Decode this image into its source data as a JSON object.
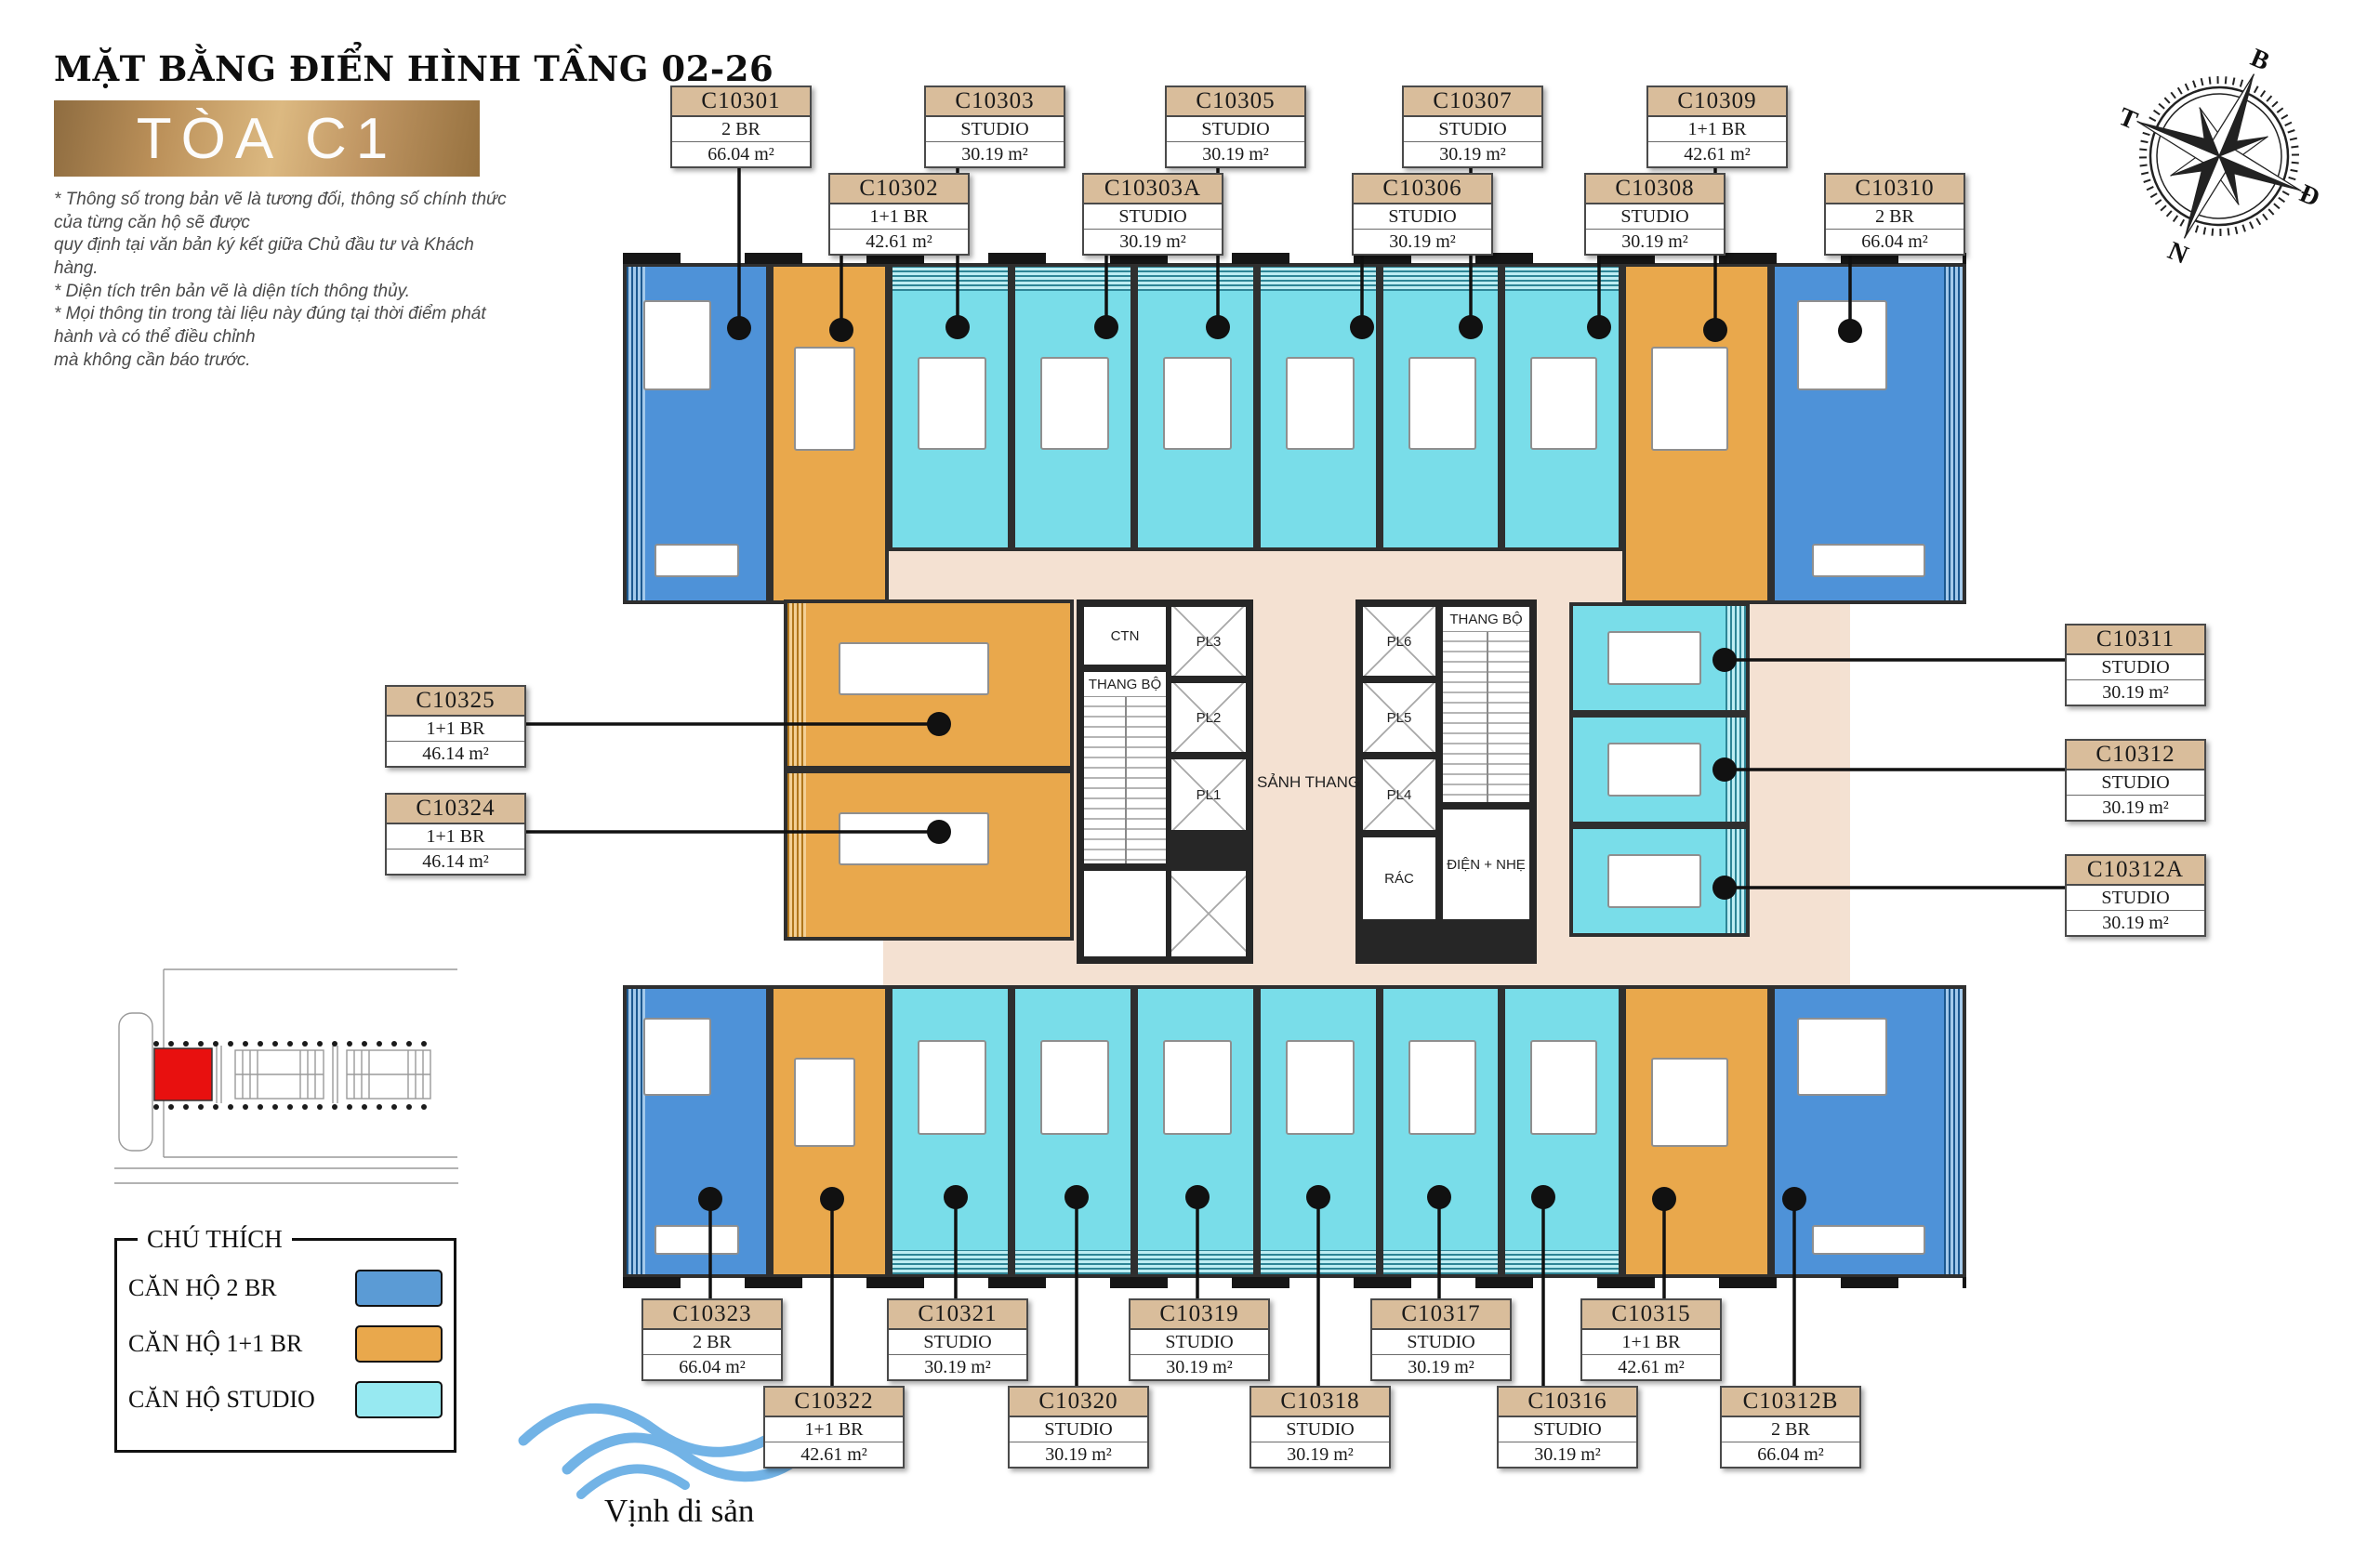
{
  "header": {
    "title": "MẶT BẰNG ĐIỂN HÌNH TẦNG 02-26",
    "building": "TÒA C1",
    "disclaimer_lines": [
      "* Thông số trong bản vẽ là tương đối, thông số chính thức của từng căn hộ sẽ được",
      "quy định tại văn bản ký kết giữa Chủ đầu tư và Khách hàng.",
      "* Diện tích trên bản vẽ là diện tích thông thủy.",
      "* Mọi thông tin trong tài liệu này đúng tại thời điểm phát hành và có thể điều chỉnh",
      "mà không cần báo trước."
    ]
  },
  "compass": {
    "north": "B",
    "east": "Đ",
    "south": "N",
    "west": "T"
  },
  "legend": {
    "title": "CHÚ THÍCH",
    "items": [
      {
        "label": "CĂN HỘ 2 BR",
        "color": "#5b9bd5"
      },
      {
        "label": "CĂN HỘ 1+1 BR",
        "color": "#e9a84c"
      },
      {
        "label": "CĂN HỘ  STUDIO",
        "color": "#97e9f1"
      }
    ]
  },
  "logo": {
    "text": "Vịnh di sản"
  },
  "core": {
    "ctn": "CTN",
    "stair_left": "THANG BỘ",
    "stair_right": "THANG BỘ",
    "lobby": "SẢNH THANG",
    "lifts": {
      "pl1": "PL1",
      "pl2": "PL2",
      "pl3": "PL3",
      "pl4": "PL4",
      "pl5": "PL5",
      "pl6": "PL6"
    },
    "trash": "RÁC",
    "electrical": "ĐIỆN + NHẸ"
  },
  "units": [
    {
      "id": "C10301",
      "type": "2 BR",
      "area": "66.04 m²"
    },
    {
      "id": "C10302",
      "type": "1+1 BR",
      "area": "42.61 m²"
    },
    {
      "id": "C10303",
      "type": "STUDIO",
      "area": "30.19 m²"
    },
    {
      "id": "C10303A",
      "type": "STUDIO",
      "area": "30.19 m²"
    },
    {
      "id": "C10305",
      "type": "STUDIO",
      "area": "30.19 m²"
    },
    {
      "id": "C10306",
      "type": "STUDIO",
      "area": "30.19 m²"
    },
    {
      "id": "C10307",
      "type": "STUDIO",
      "area": "30.19 m²"
    },
    {
      "id": "C10308",
      "type": "STUDIO",
      "area": "30.19 m²"
    },
    {
      "id": "C10309",
      "type": "1+1 BR",
      "area": "42.61 m²"
    },
    {
      "id": "C10310",
      "type": "2 BR",
      "area": "66.04 m²"
    },
    {
      "id": "C10311",
      "type": "STUDIO",
      "area": "30.19 m²"
    },
    {
      "id": "C10312",
      "type": "STUDIO",
      "area": "30.19 m²"
    },
    {
      "id": "C10312A",
      "type": "STUDIO",
      "area": "30.19 m²"
    },
    {
      "id": "C10312B",
      "type": "2 BR",
      "area": "66.04 m²"
    },
    {
      "id": "C10315",
      "type": "1+1 BR",
      "area": "42.61 m²"
    },
    {
      "id": "C10316",
      "type": "STUDIO",
      "area": "30.19 m²"
    },
    {
      "id": "C10317",
      "type": "STUDIO",
      "area": "30.19 m²"
    },
    {
      "id": "C10318",
      "type": "STUDIO",
      "area": "30.19 m²"
    },
    {
      "id": "C10319",
      "type": "STUDIO",
      "area": "30.19 m²"
    },
    {
      "id": "C10320",
      "type": "STUDIO",
      "area": "30.19 m²"
    },
    {
      "id": "C10321",
      "type": "STUDIO",
      "area": "30.19 m²"
    },
    {
      "id": "C10322",
      "type": "1+1 BR",
      "area": "42.61 m²"
    },
    {
      "id": "C10323",
      "type": "2 BR",
      "area": "66.04 m²"
    },
    {
      "id": "C10324",
      "type": "1+1 BR",
      "area": "46.14 m²"
    },
    {
      "id": "C10325",
      "type": "1+1 BR",
      "area": "46.14 m²"
    }
  ]
}
